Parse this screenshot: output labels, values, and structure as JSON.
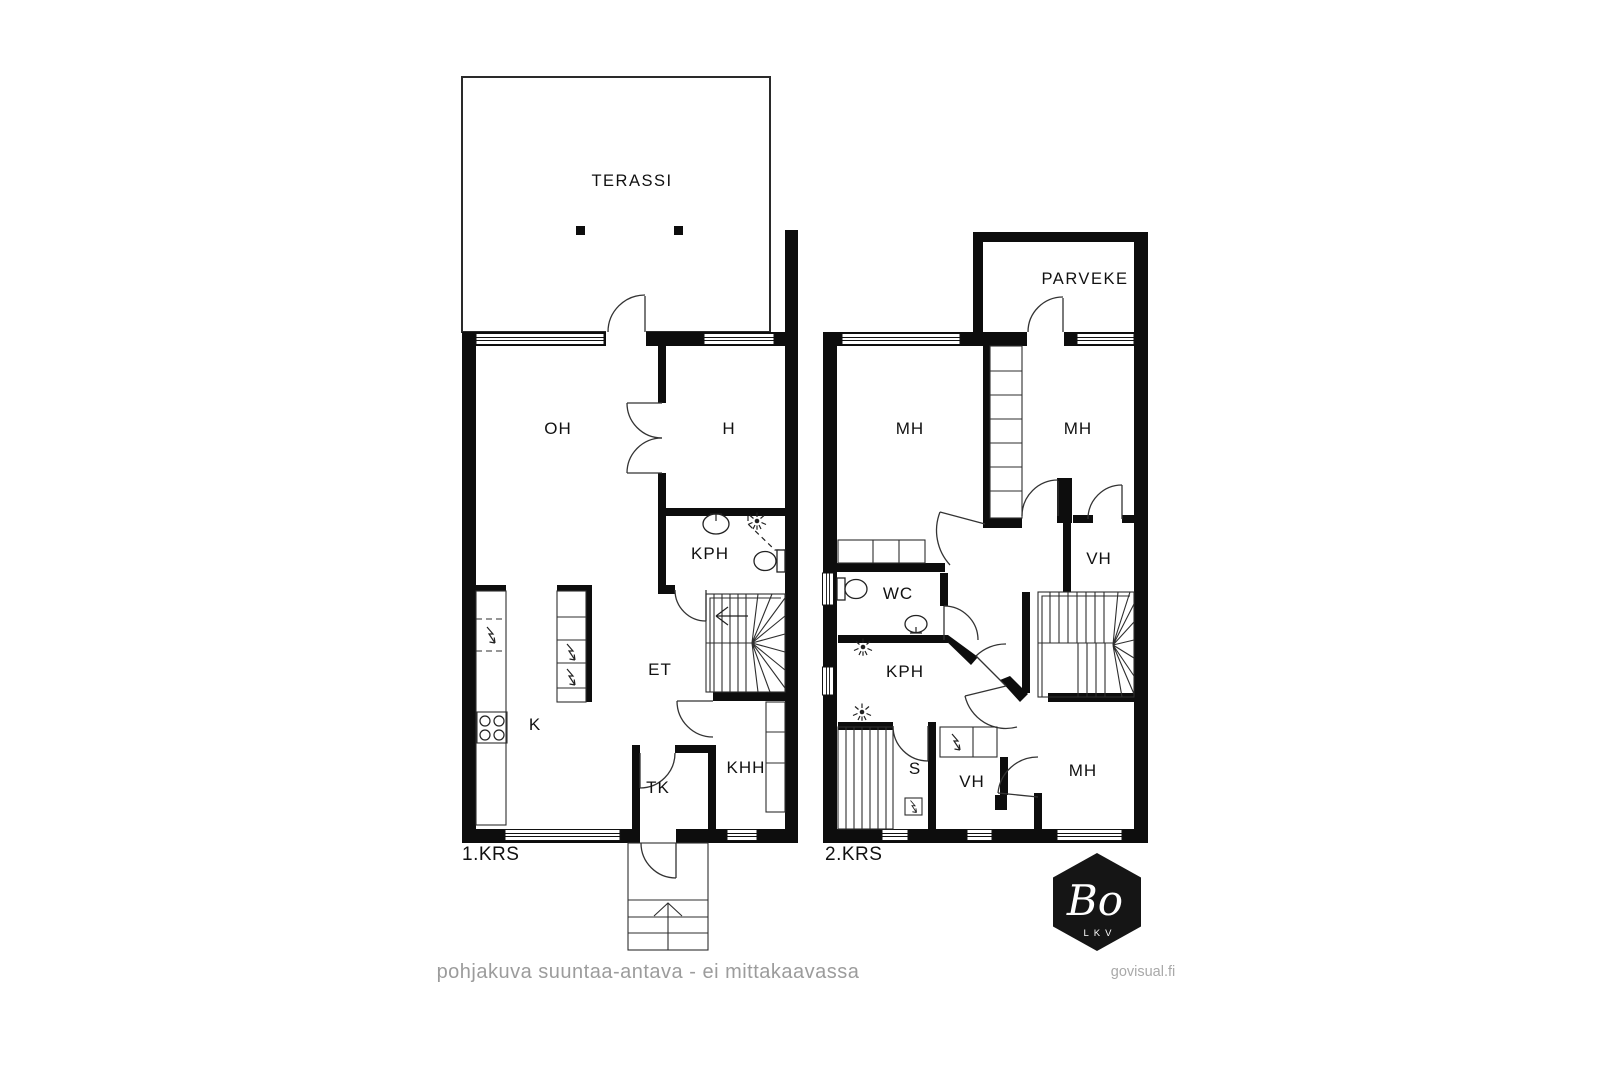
{
  "document": {
    "type": "floor-plan",
    "language": "fi"
  },
  "colors": {
    "background": "#ffffff",
    "wall": "#0d0d0d",
    "muted_text": "#9c9c9c",
    "logo_background": "#151515"
  },
  "floor1": {
    "name": "1.KRS",
    "rooms": [
      {
        "id": "terassi",
        "label": "TERASSI"
      },
      {
        "id": "oh",
        "label": "OH"
      },
      {
        "id": "h",
        "label": "H"
      },
      {
        "id": "kph",
        "label": "KPH"
      },
      {
        "id": "et",
        "label": "ET"
      },
      {
        "id": "k",
        "label": "K"
      },
      {
        "id": "tk",
        "label": "TK"
      },
      {
        "id": "khh",
        "label": "KHH"
      }
    ]
  },
  "floor2": {
    "name": "2.KRS",
    "rooms": [
      {
        "id": "parveke",
        "label": "PARVEKE"
      },
      {
        "id": "mh_left",
        "label": "MH"
      },
      {
        "id": "mh_right",
        "label": "MH"
      },
      {
        "id": "vh_upper",
        "label": "VH"
      },
      {
        "id": "wc",
        "label": "WC"
      },
      {
        "id": "kph",
        "label": "KPH"
      },
      {
        "id": "s",
        "label": "S"
      },
      {
        "id": "vh_lower",
        "label": "VH"
      },
      {
        "id": "mh_lower",
        "label": "MH"
      }
    ]
  },
  "icons": {
    "appliance": "lightning-bolt-icon",
    "shower": "shower-spray-icon",
    "toilet": "toilet-icon",
    "sink": "sink-icon",
    "stove": "four-burner-stove-icon",
    "stairs_direction": "up-arrow"
  },
  "footer": {
    "disclaimer": "pohjakuva suuntaa-antava - ei mittakaavassa",
    "watermark": "govisual.fi"
  },
  "logo": {
    "brand": "Bo",
    "subtitle": "LKV"
  }
}
